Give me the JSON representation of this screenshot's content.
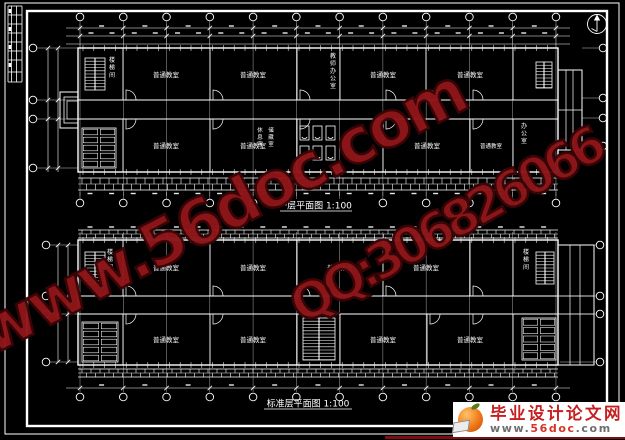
{
  "sheet": {
    "background": "#000000",
    "line_color": "#ffffff"
  },
  "plans": {
    "top": {
      "title": "一层平面图 1:100",
      "rooms_north": [
        "普通教室",
        "普通教室",
        "普通教室",
        "普通教室"
      ],
      "vertical_room_north": "教师办公室",
      "rooms_south": [
        "普通教室",
        "普通教室",
        "普通教室",
        "普通教室"
      ],
      "vertical_rooms_south": [
        "休息室",
        "储藏室"
      ],
      "vertical_room_right": "办公室",
      "stair_label": "楼梯间"
    },
    "bottom": {
      "title": "标准层平面图 1:100",
      "rooms_north": [
        "普通教室",
        "普通教室",
        "普通教室",
        "普通教室"
      ],
      "rooms_south": [
        "普通教室",
        "普通教室",
        "普通教室",
        "普通教室"
      ],
      "stair_label_left": "楼梯间",
      "stair_label_right": "楼梯间"
    }
  },
  "watermark": {
    "line1": "www.56doc.com",
    "line2": "QQ:306826066",
    "fill_color": "#8e1619",
    "outline_color": "#3a0507"
  },
  "footer_logo": {
    "site_name": "毕业设计论文网",
    "url_prefix": "www.",
    "url_mid": "56doc",
    "url_suffix": ".com",
    "name_color": "#c51f21",
    "underline_color": "#7e0d10"
  }
}
